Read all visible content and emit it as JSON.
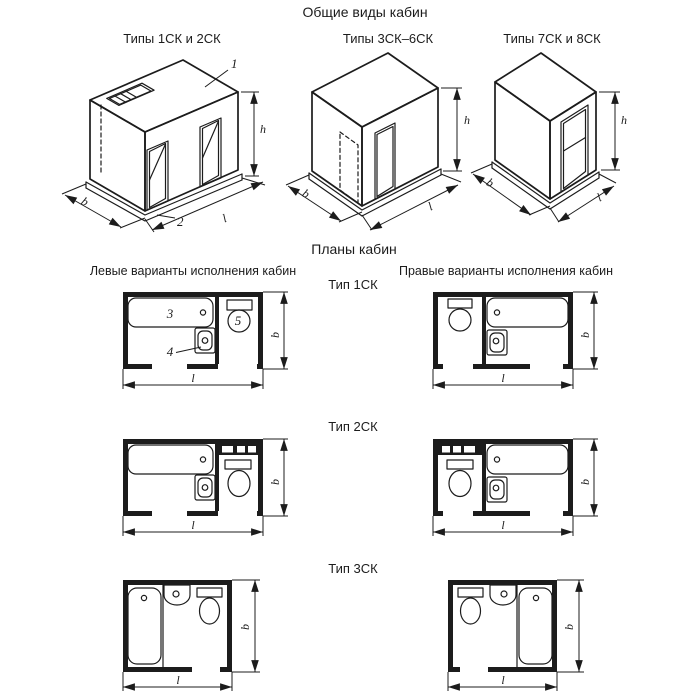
{
  "document": {
    "general_views_title": "Общие виды кабин",
    "plans_title": "Планы кабин",
    "left_variants_title": "Левые варианты исполнения кабин",
    "right_variants_title": "Правые варианты исполнения кабин"
  },
  "general_views": {
    "types_1sk_2sk": "Типы 1СК и 2СК",
    "types_3sk_6sk": "Типы 3СК–6СК",
    "types_7sk_8sk": "Типы 7СК и 8СК"
  },
  "plan_types": {
    "type_1sk": "Тип 1СК",
    "type_2sk": "Тип 2СК",
    "type_3sk": "Тип 3СК"
  },
  "callouts": {
    "cabin": "1",
    "base": "2",
    "bathtub": "3",
    "washbasin": "4",
    "toilet": "5"
  },
  "dimensions": {
    "width": "b",
    "length": "l",
    "height": "h"
  },
  "colors": {
    "line": "#1c1c1c",
    "background": "#ffffff"
  }
}
